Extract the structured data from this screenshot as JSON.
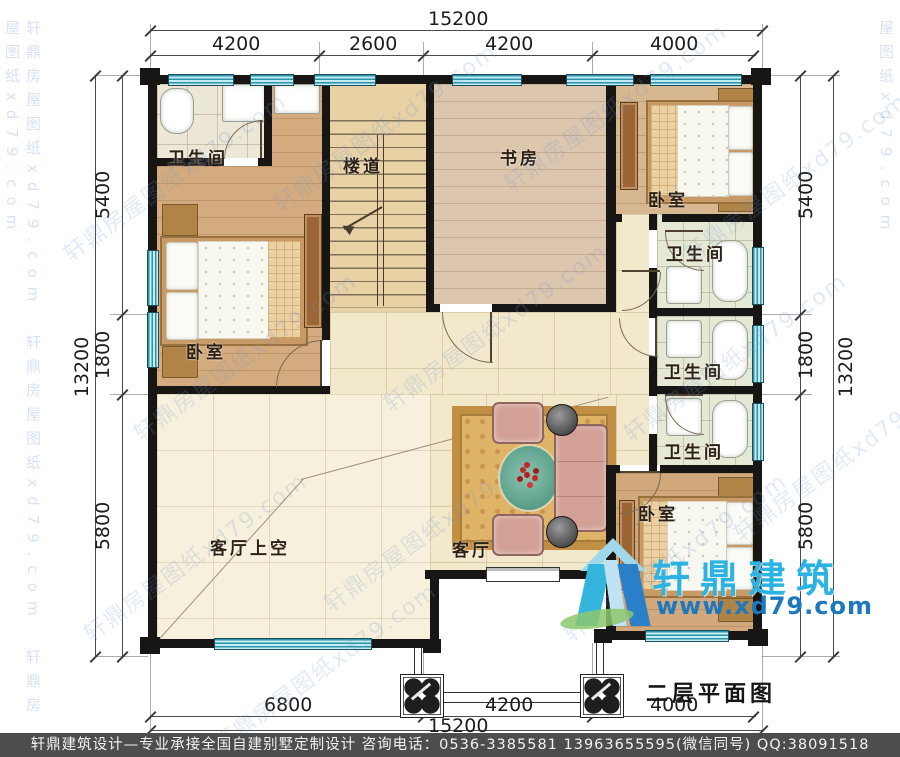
{
  "title": "二层平面图",
  "watermark": {
    "text": "轩鼎房屋图纸xd79.com"
  },
  "logo": {
    "name": "轩鼎建筑",
    "url": "www.xd79.com",
    "cyan": "#2cb3e2",
    "blue": "#1d78c0",
    "green": "#8cc86f"
  },
  "footer": "轩鼎建筑设计—专业承接全国自建别墅定制设计  咨询电话：0536-3385581  13963655595(微信同号)  QQ:38091518",
  "dims": {
    "top_total": "15200",
    "top_segments": [
      "4200",
      "2600",
      "4200",
      "4000"
    ],
    "bottom_total": "15200",
    "bottom_segments": [
      "6800",
      "4200",
      "4000"
    ],
    "left_total": "13200",
    "left_segments": [
      "5400",
      "1800",
      "5800"
    ],
    "right_total": "13200",
    "right_segments": [
      "5400",
      "1800",
      "5800"
    ]
  },
  "rooms": {
    "bathroom": "卫生间",
    "stairway": "楼道",
    "study": "书房",
    "bedroom": "卧室",
    "living_void": "客厅上空",
    "living": "客厅"
  },
  "colors": {
    "wall": "#171615",
    "window": "#2e93a8",
    "wood": "#d7b78f",
    "tile": "#e5e8d5",
    "cream": "#f2e8cc"
  }
}
